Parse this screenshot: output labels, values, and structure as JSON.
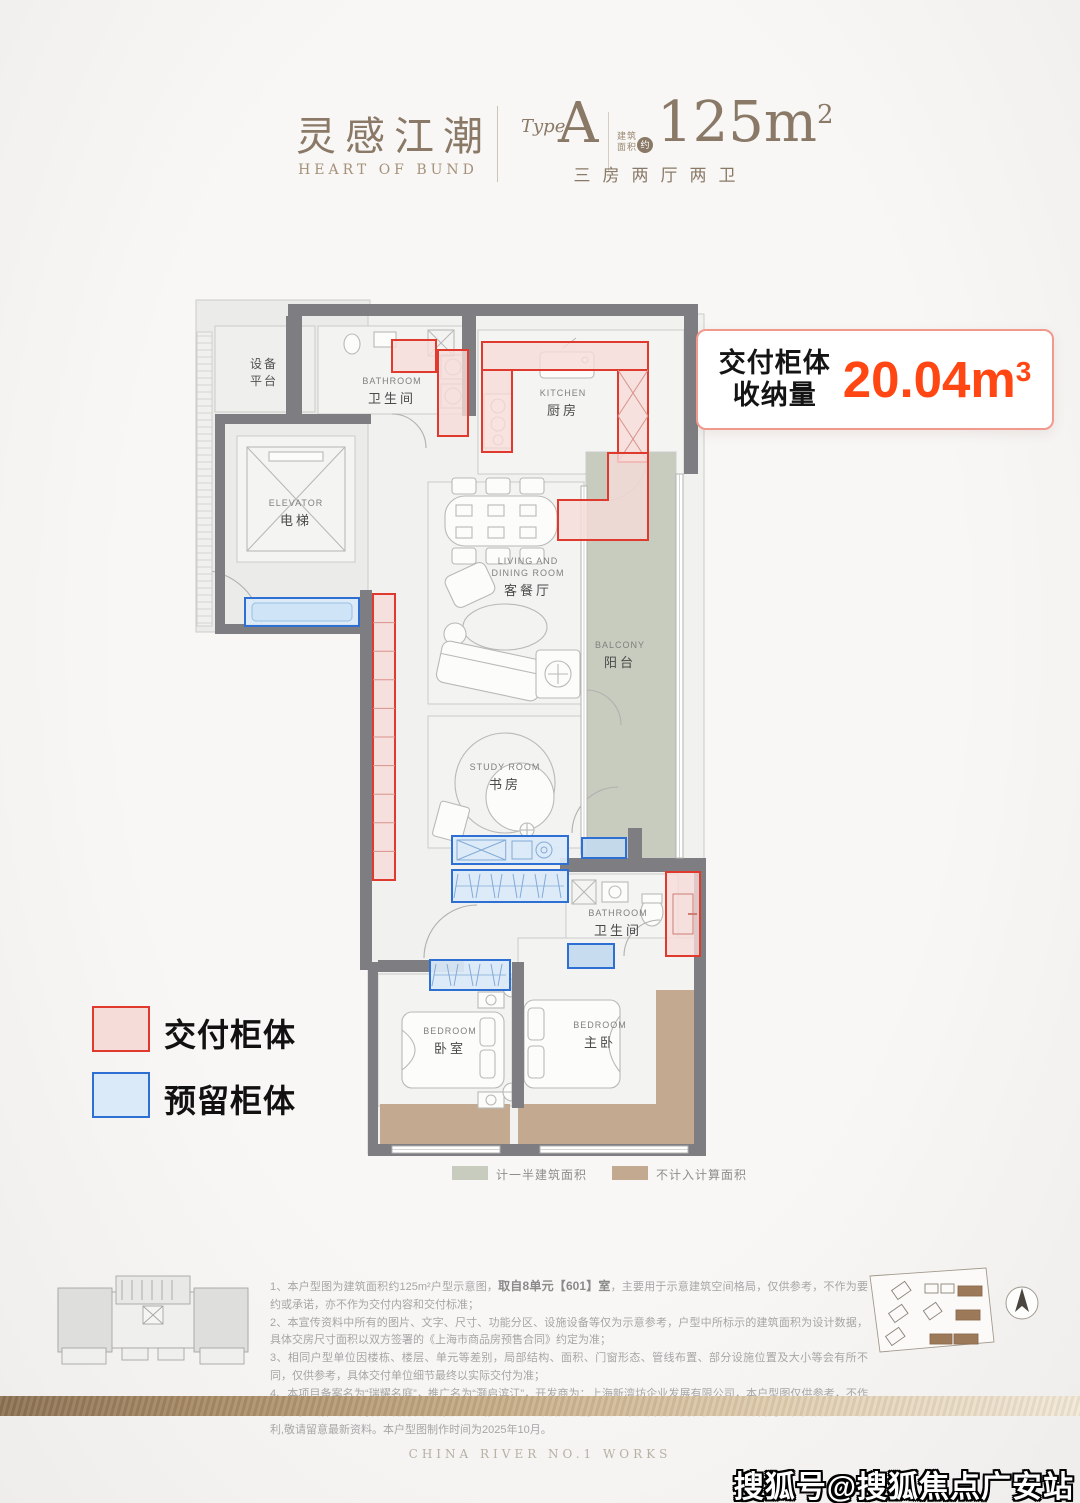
{
  "header": {
    "brand_zh": "灵感江潮",
    "brand_en": "HEART OF BUND",
    "type_label": "Type",
    "type_value": "A",
    "area_prefix_line1": "建筑",
    "area_prefix_line2": "面积",
    "area_approx": "约",
    "area_value": "125m",
    "area_sup": "2",
    "layout_desc": "三房两厅两卫"
  },
  "badge": {
    "label_line1": "交付柜体",
    "label_line2": "收纳量",
    "value": "20.04m",
    "sup": "3"
  },
  "legend": {
    "delivered": "交付柜体",
    "reserved": "预留柜体"
  },
  "plan_legend": [
    {
      "label": "计一半建筑面积"
    },
    {
      "label": "不计入计算面积"
    }
  ],
  "colors": {
    "accent_orange": "#ff4613",
    "badge_border": "#f2998e",
    "delivered_fill": "#f6dcd9",
    "delivered_border": "#e03a2f",
    "reserved_fill": "#dbeaf8",
    "reserved_border": "#2d6fd2",
    "balcony": "#c7ccbf",
    "tan": "#c2a98f",
    "wall": "#7e7e82",
    "brand_brown": "#8a7967"
  },
  "plan": {
    "rooms": [
      {
        "name": "public-hall",
        "x": 196,
        "y": 300,
        "w": 174,
        "h": 332,
        "fill": "#ebebe9"
      },
      {
        "name": "unit-floor",
        "x": 368,
        "y": 314,
        "w": 336,
        "h": 840,
        "fill": "#f1f1ef"
      },
      {
        "name": "equipment-platform",
        "x": 215,
        "y": 326,
        "w": 100,
        "h": 86,
        "fill": "#efefed"
      },
      {
        "name": "bathroom-top",
        "x": 318,
        "y": 326,
        "w": 148,
        "h": 88,
        "fill": "#f3f3f1"
      },
      {
        "name": "elevator",
        "x": 237,
        "y": 436,
        "w": 118,
        "h": 126,
        "fill": "#f4f4f2"
      },
      {
        "name": "kitchen",
        "x": 478,
        "y": 330,
        "w": 206,
        "h": 144,
        "fill": "#f4f4f2"
      },
      {
        "name": "living-dining",
        "x": 428,
        "y": 482,
        "w": 156,
        "h": 222,
        "fill": "#f3f3f1"
      },
      {
        "name": "balcony",
        "x": 586,
        "y": 452,
        "w": 90,
        "h": 406,
        "fill": "#c7ccbf"
      },
      {
        "name": "study",
        "x": 428,
        "y": 716,
        "w": 156,
        "h": 132,
        "fill": "#f3f3f1"
      },
      {
        "name": "bathroom-bottom",
        "x": 566,
        "y": 874,
        "w": 112,
        "h": 86,
        "fill": "#f4f4f2"
      },
      {
        "name": "bedroom",
        "x": 378,
        "y": 974,
        "w": 134,
        "h": 132,
        "fill": "#f3f3f1"
      },
      {
        "name": "master-bedroom",
        "x": 518,
        "y": 938,
        "w": 178,
        "h": 168,
        "fill": "#f3f3f1"
      }
    ],
    "tan_areas": [
      {
        "x": 380,
        "y": 1104,
        "w": 130,
        "h": 42
      },
      {
        "x": 518,
        "y": 1104,
        "w": 178,
        "h": 42
      },
      {
        "x": 656,
        "y": 990,
        "w": 40,
        "h": 114
      }
    ],
    "walls": [
      {
        "x": 288,
        "y": 304,
        "w": 410,
        "h": 12
      },
      {
        "x": 286,
        "y": 316,
        "w": 16,
        "h": 100
      },
      {
        "x": 215,
        "y": 414,
        "w": 156,
        "h": 10
      },
      {
        "x": 215,
        "y": 414,
        "w": 10,
        "h": 220
      },
      {
        "x": 215,
        "y": 624,
        "w": 156,
        "h": 10
      },
      {
        "x": 684,
        "y": 304,
        "w": 14,
        "h": 170
      },
      {
        "x": 462,
        "y": 316,
        "w": 14,
        "h": 100
      },
      {
        "x": 360,
        "y": 590,
        "w": 12,
        "h": 380
      },
      {
        "x": 560,
        "y": 858,
        "w": 144,
        "h": 14
      },
      {
        "x": 628,
        "y": 828,
        "w": 14,
        "h": 32
      },
      {
        "x": 378,
        "y": 960,
        "w": 86,
        "h": 12
      },
      {
        "x": 512,
        "y": 962,
        "w": 12,
        "h": 146
      },
      {
        "x": 368,
        "y": 962,
        "w": 10,
        "h": 190
      },
      {
        "x": 694,
        "y": 858,
        "w": 12,
        "h": 292
      },
      {
        "x": 368,
        "y": 1144,
        "w": 338,
        "h": 12
      }
    ],
    "windows": [
      {
        "x": 676,
        "y": 474,
        "w": 7,
        "h": 384
      },
      {
        "x": 581,
        "y": 486,
        "w": 6,
        "h": 368
      },
      {
        "x": 392,
        "y": 1146,
        "w": 108,
        "h": 7
      },
      {
        "x": 540,
        "y": 1146,
        "w": 148,
        "h": 7
      }
    ],
    "hatch": {
      "x": 197,
      "y": 332,
      "w": 15,
      "h": 294
    },
    "cabinets_delivered": [
      {
        "x": 392,
        "y": 340,
        "w": 44,
        "h": 32
      },
      {
        "x": 438,
        "y": 350,
        "w": 30,
        "h": 86
      },
      {
        "x": 482,
        "y": 342,
        "w": 166,
        "h": 28
      },
      {
        "x": 482,
        "y": 370,
        "w": 30,
        "h": 82
      },
      {
        "x": 618,
        "y": 370,
        "w": 30,
        "h": 92,
        "xcells": 2
      },
      {
        "poly": "608,453 648,453 648,540 558,540 558,500 608,500"
      },
      {
        "x": 373,
        "y": 594,
        "w": 22,
        "h": 286,
        "segs": 10
      },
      {
        "x": 666,
        "y": 872,
        "w": 34,
        "h": 84,
        "door": true
      }
    ],
    "cabinets_reserved": [
      {
        "x": 245,
        "y": 598,
        "w": 114,
        "h": 28,
        "inner": true
      },
      {
        "x": 452,
        "y": 836,
        "w": 116,
        "h": 28,
        "xbox": true
      },
      {
        "x": 582,
        "y": 838,
        "w": 44,
        "h": 20,
        "solid": true
      },
      {
        "x": 452,
        "y": 870,
        "w": 116,
        "h": 32,
        "hangers": true
      },
      {
        "x": 430,
        "y": 960,
        "w": 80,
        "h": 30,
        "hangers": true
      },
      {
        "x": 568,
        "y": 944,
        "w": 46,
        "h": 24,
        "solid": true
      }
    ],
    "labels": [
      {
        "zh": "设备",
        "zh2": "平台",
        "x": 264,
        "y": 368
      },
      {
        "en": "BATHROOM",
        "zh": "卫生间",
        "x": 392,
        "y": 384
      },
      {
        "en": "ELEVATOR",
        "zh": "电梯",
        "x": 296,
        "y": 506
      },
      {
        "en": "KITCHEN",
        "zh": "厨房",
        "x": 563,
        "y": 396
      },
      {
        "en": "LIVING AND",
        "en2": "DINING ROOM",
        "zh": "客餐厅",
        "x": 528,
        "y": 564
      },
      {
        "en": "BALCONY",
        "zh": "阳台",
        "x": 620,
        "y": 648
      },
      {
        "en": "STUDY ROOM",
        "zh": "书房",
        "x": 505,
        "y": 770
      },
      {
        "en": "BATHROOM",
        "zh": "卫生间",
        "x": 618,
        "y": 916
      },
      {
        "en": "BEDROOM",
        "zh": "卧室",
        "x": 450,
        "y": 1034
      },
      {
        "en": "BEDROOM",
        "zh": "主卧",
        "x": 600,
        "y": 1028
      }
    ]
  },
  "notes": {
    "line1_pre": "1、本户型图为建筑面积约125m²户型示意图，",
    "line1_bold": "取自8单元【601】室",
    "line1_post": "，主要用于示意建筑空间格局，仅供参考，不作为要约或承诺，亦不作为交付内容和交付标准；",
    "line2": "2、本宣传资料中所有的图片、文字、尺寸、功能分区、设施设备等仅为示意参考，户型中所标示的建筑面积为设计数据，具体交房尺寸面积以双方签署的《上海市商品房预售合同》约定为准；",
    "line3": "3、相同户型单位因楼栋、楼层、单元等差别，局部结构、面积、门窗形态、管线布置、部分设施位置及大小等会有所不同，仅供参考，具体交付单位细节最终以实际交付为准；",
    "line4": "4、本项目备案名为“瑞耀名庭”，推广名为“灏启滨江”，开发商为：上海新湾坊企业发展有限公司，本户型图仅供参考，不作为要约邀请，相关内容不排除因政府相关规划、规定及开发商未能知晓的原因而发生变化，本公司保留对宣传资料修改的权利,敬请留意最新资料。本户型图制作时间为2025年10月。"
  },
  "footer": {
    "text": "CHINA RIVER NO.1 WORKS"
  },
  "watermark": "搜狐号@搜狐焦点广安站"
}
